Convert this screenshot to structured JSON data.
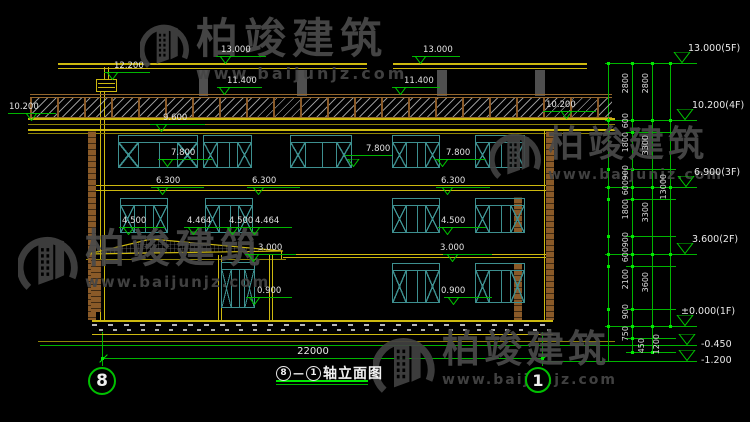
{
  "title": {
    "axis_start": "8",
    "dash": "—",
    "axis_end": "1",
    "text": "轴立面图"
  },
  "axes": {
    "left": "8",
    "right": "1"
  },
  "dims": {
    "overall_width": "22000"
  },
  "watermark": {
    "brand": "柏竣建筑",
    "url": "www.baijunjz.com",
    "brand_color": "#4a4a4a",
    "logo_color": "#424242",
    "instances": [
      {
        "x": 140,
        "y": 18,
        "lh": 56,
        "ts": 42,
        "ws": 16,
        "tls": 6,
        "wls": 3
      },
      {
        "x": 490,
        "y": 127,
        "lh": 58,
        "ts": 36,
        "ws": 14,
        "tls": 4,
        "wls": 2
      },
      {
        "x": 18,
        "y": 229,
        "lh": 68,
        "ts": 40,
        "ws": 15,
        "tls": 5,
        "wls": 2
      },
      {
        "x": 373,
        "y": 330,
        "lh": 70,
        "ts": 38,
        "ws": 14,
        "tls": 4,
        "wls": 2
      }
    ]
  },
  "colors": {
    "yellow": "#cdb90f",
    "yellow_dim": "#8f8408",
    "green": "#00b400",
    "green_bright": "#00e800",
    "brown": "#8a5a28",
    "brown_rail": "#96682e",
    "teal": "#3d8f8f",
    "post_gray": "#4f4f4f",
    "text": "#e2e2e2",
    "watermark": "#4a4a4a"
  },
  "geometry": {
    "rects": [
      [
        58,
        63,
        309,
        2,
        "y"
      ],
      [
        58,
        68,
        309,
        1,
        "y"
      ],
      [
        393,
        63,
        194,
        2,
        "y"
      ],
      [
        393,
        68,
        194,
        1,
        "y"
      ],
      [
        199,
        70,
        9,
        26,
        "d"
      ],
      [
        297,
        70,
        10,
        26,
        "d"
      ],
      [
        437,
        70,
        10,
        26,
        "d"
      ],
      [
        535,
        70,
        10,
        26,
        "d"
      ],
      [
        104,
        67,
        1,
        12,
        "y"
      ],
      [
        108,
        67,
        1,
        12,
        "y"
      ],
      [
        96,
        79,
        21,
        1,
        "y"
      ],
      [
        96,
        91,
        21,
        1,
        "y"
      ],
      [
        96,
        79,
        1,
        12,
        "y"
      ],
      [
        116,
        79,
        1,
        12,
        "y"
      ],
      [
        98,
        83,
        17,
        1,
        "y"
      ],
      [
        98,
        87,
        17,
        1,
        "y"
      ],
      [
        100,
        92,
        1,
        228,
        "y"
      ],
      [
        104,
        92,
        1,
        228,
        "y"
      ],
      [
        30,
        94,
        582,
        1,
        "b2"
      ],
      [
        30,
        97,
        582,
        1,
        "b2"
      ],
      [
        28,
        118,
        587,
        2,
        "y"
      ],
      [
        28,
        129,
        587,
        2,
        "y"
      ],
      [
        28,
        124,
        587,
        1,
        "y2"
      ],
      [
        28,
        133,
        587,
        1,
        "y2"
      ],
      [
        95,
        131,
        1,
        190,
        "y"
      ],
      [
        544,
        131,
        1,
        189,
        "y"
      ],
      [
        553,
        131,
        1,
        189,
        "y"
      ],
      [
        95,
        185,
        458,
        1,
        "y"
      ],
      [
        95,
        190,
        458,
        1,
        "y"
      ],
      [
        283,
        254,
        270,
        1,
        "y"
      ],
      [
        283,
        257,
        270,
        1,
        "y"
      ],
      [
        281,
        251,
        1,
        8,
        "y"
      ],
      [
        86,
        259,
        200,
        1,
        "y2"
      ],
      [
        218,
        255,
        1,
        65,
        "y"
      ],
      [
        221,
        255,
        1,
        65,
        "y"
      ],
      [
        269,
        255,
        1,
        65,
        "y"
      ],
      [
        272,
        255,
        1,
        65,
        "y"
      ],
      [
        38,
        341,
        577,
        1,
        "y2"
      ],
      [
        40,
        345,
        657,
        1,
        "g"
      ],
      [
        543,
        361,
        154,
        1,
        "g"
      ],
      [
        103,
        358,
        440,
        1,
        "g"
      ],
      [
        102,
        332,
        1,
        34,
        "g"
      ],
      [
        542,
        332,
        1,
        34,
        "g"
      ],
      [
        605,
        63,
        92,
        1,
        "g"
      ],
      [
        605,
        120,
        92,
        1,
        "g"
      ],
      [
        605,
        187,
        92,
        1,
        "g"
      ],
      [
        605,
        254,
        92,
        1,
        "g"
      ],
      [
        605,
        326,
        92,
        1,
        "g"
      ],
      [
        626,
        132,
        50,
        1,
        "g"
      ],
      [
        626,
        169,
        50,
        1,
        "g"
      ],
      [
        626,
        199,
        50,
        1,
        "g"
      ],
      [
        626,
        236,
        50,
        1,
        "g"
      ],
      [
        626,
        266,
        50,
        1,
        "g"
      ],
      [
        626,
        309,
        50,
        1,
        "g"
      ],
      [
        626,
        338,
        50,
        1,
        "g"
      ],
      [
        626,
        352,
        50,
        1,
        "g"
      ],
      [
        632,
        63,
        1,
        289,
        "g"
      ],
      [
        652,
        63,
        1,
        289,
        "g"
      ],
      [
        670,
        63,
        1,
        263,
        "g"
      ],
      [
        608,
        63,
        1,
        298,
        "g"
      ],
      [
        276,
        380,
        92,
        2,
        "gb"
      ],
      [
        276,
        384,
        92,
        1,
        "g"
      ]
    ],
    "parapet": [
      30,
      98,
      582,
      19
    ],
    "plinth": [
      92,
      320,
      461,
      12
    ],
    "pilasters": [
      [
        88,
        131,
        8,
        189
      ],
      [
        546,
        131,
        8,
        189
      ],
      [
        514,
        197,
        8,
        36
      ],
      [
        514,
        263,
        8,
        57
      ],
      [
        91,
        260,
        10,
        52
      ]
    ],
    "hip_canopy": {
      "x": 86,
      "y": 232,
      "w": 200,
      "h": 24,
      "points": "2,22 65,7 197,19"
    },
    "slashes": [
      [
        103,
        358
      ],
      [
        543,
        358
      ]
    ]
  },
  "windows": [
    [
      118,
      135,
      80,
      33,
      20
    ],
    [
      203,
      135,
      49,
      33,
      14
    ],
    [
      290,
      135,
      62,
      33,
      15
    ],
    [
      392,
      135,
      48,
      33,
      14
    ],
    [
      475,
      135,
      50,
      33,
      14
    ],
    [
      120,
      198,
      48,
      35,
      14
    ],
    [
      205,
      198,
      48,
      35,
      14
    ],
    [
      392,
      198,
      48,
      35,
      14
    ],
    [
      475,
      198,
      50,
      35,
      14
    ],
    [
      392,
      263,
      48,
      40,
      14
    ],
    [
      475,
      263,
      50,
      40,
      14
    ],
    [
      221,
      262,
      34,
      46,
      10
    ]
  ],
  "markers_left": [
    {
      "l": "13.000",
      "t": [
        225,
        64
      ],
      "ln": [
        216,
        266,
        56
      ],
      "tx": [
        221,
        46
      ]
    },
    {
      "l": "12.200",
      "t": [
        112,
        80
      ],
      "ln": [
        104,
        150,
        72
      ],
      "tx": [
        114,
        62
      ]
    },
    {
      "l": "11.400",
      "t": [
        224,
        95
      ],
      "ln": [
        217,
        262,
        87
      ],
      "tx": [
        227,
        77
      ]
    },
    {
      "l": "13.000",
      "t": [
        420,
        64
      ],
      "ln": [
        412,
        460,
        56
      ],
      "tx": [
        423,
        46
      ]
    },
    {
      "l": "11.400",
      "t": [
        400,
        95
      ],
      "ln": [
        392,
        440,
        87
      ],
      "tx": [
        404,
        77
      ]
    },
    {
      "l": "10.200",
      "t": [
        31,
        121
      ],
      "ln": [
        8,
        56,
        113
      ],
      "tx": [
        9,
        103
      ]
    },
    {
      "l": "10.200",
      "t": [
        566,
        119
      ],
      "ln": [
        543,
        596,
        111
      ],
      "tx": [
        546,
        101
      ]
    },
    {
      "l": "9.600",
      "t": [
        161,
        132
      ],
      "ln": [
        150,
        205,
        124
      ],
      "tx": [
        163,
        114
      ]
    },
    {
      "l": "7.800",
      "t": [
        167,
        167
      ],
      "ln": [
        158,
        212,
        159
      ],
      "tx": [
        171,
        149
      ]
    },
    {
      "l": "7.800",
      "t": [
        353,
        167
      ],
      "ln": [
        345,
        392,
        155
      ],
      "tx": [
        366,
        145
      ]
    },
    {
      "l": "7.800",
      "t": [
        442,
        167
      ],
      "ln": [
        434,
        486,
        159
      ],
      "tx": [
        446,
        149
      ]
    },
    {
      "l": "6.300",
      "t": [
        162,
        195
      ],
      "ln": [
        151,
        204,
        187
      ],
      "tx": [
        156,
        177
      ]
    },
    {
      "l": "6.300",
      "t": [
        258,
        195
      ],
      "ln": [
        247,
        300,
        187
      ],
      "tx": [
        252,
        177
      ]
    },
    {
      "l": "6.300",
      "t": [
        447,
        195
      ],
      "ln": [
        436,
        490,
        187
      ],
      "tx": [
        441,
        177
      ]
    },
    {
      "l": "4.500",
      "t": [
        128,
        235
      ],
      "ln": [
        119,
        165,
        227
      ],
      "tx": [
        122,
        217
      ]
    },
    {
      "l": "4.464",
      "t": [
        193,
        235
      ],
      "ln": [
        184,
        230,
        227
      ],
      "tx": [
        187,
        217
      ]
    },
    {
      "l": "4.500",
      "t": [
        232,
        235
      ],
      "ln": [
        225,
        271,
        227
      ],
      "tx": [
        229,
        217
      ]
    },
    {
      "l": "4.464",
      "t": [
        254,
        235
      ],
      "ln": [
        246,
        292,
        227
      ],
      "tx": [
        255,
        217
      ]
    },
    {
      "l": "4.500",
      "t": [
        447,
        235
      ],
      "ln": [
        438,
        486,
        227
      ],
      "tx": [
        441,
        217
      ]
    },
    {
      "l": "3.000",
      "t": [
        253,
        262
      ],
      "ln": [
        245,
        296,
        254
      ],
      "tx": [
        258,
        244
      ]
    },
    {
      "l": "3.000",
      "t": [
        452,
        262
      ],
      "ln": [
        443,
        492,
        254
      ],
      "tx": [
        440,
        244
      ]
    },
    {
      "l": "0.900",
      "t": [
        254,
        305
      ],
      "ln": [
        246,
        292,
        297
      ],
      "tx": [
        257,
        287
      ]
    },
    {
      "l": "0.900",
      "t": [
        453,
        305
      ],
      "ln": [
        444,
        492,
        297
      ],
      "tx": [
        441,
        287
      ]
    }
  ],
  "levels_right": [
    {
      "l": "13.000(5F)",
      "t": [
        682,
        63
      ],
      "tx": [
        688,
        44
      ]
    },
    {
      "l": "10.200(4F)",
      "t": [
        685,
        120
      ],
      "tx": [
        692,
        101
      ]
    },
    {
      "l": "6.900(3F)",
      "t": [
        686,
        187
      ],
      "tx": [
        694,
        168
      ]
    },
    {
      "l": "3.600(2F)",
      "t": [
        685,
        254
      ],
      "tx": [
        692,
        235
      ]
    },
    {
      "l": "±0.000(1F)",
      "t": [
        685,
        326
      ],
      "tx": [
        681,
        307
      ]
    },
    {
      "l": "-0.450",
      "t": [
        687,
        345
      ],
      "tx": [
        701,
        340
      ]
    },
    {
      "l": "-1.200",
      "t": [
        687,
        361
      ],
      "tx": [
        701,
        356
      ]
    }
  ],
  "chains": [
    {
      "x": 632,
      "lx": 621,
      "ticks": [
        63,
        120,
        132,
        169,
        187,
        199,
        236,
        254,
        266,
        309,
        326,
        338,
        352
      ],
      "labels": [
        [
          "2800",
          91
        ],
        [
          "600",
          126
        ],
        [
          "1800",
          150
        ],
        [
          "900",
          178
        ],
        [
          "600",
          193
        ],
        [
          "1800",
          217
        ],
        [
          "900",
          245
        ],
        [
          "600",
          260
        ],
        [
          "2100",
          287
        ],
        [
          "900",
          317
        ],
        [
          "750",
          339
        ],
        [
          "450",
          351,
          637
        ]
      ]
    },
    {
      "x": 652,
      "lx": 641,
      "ticks": [
        63,
        120,
        187,
        254,
        326,
        352
      ],
      "labels": [
        [
          "2800",
          91
        ],
        [
          "3300",
          153
        ],
        [
          "3300",
          220
        ],
        [
          "3600",
          290
        ],
        [
          "1200",
          352,
          652
        ]
      ]
    },
    {
      "x": 670,
      "lx": 659,
      "ticks": [
        63,
        120,
        187,
        254,
        326
      ],
      "labels": [
        [
          "13000",
          196
        ]
      ]
    },
    {
      "x": 608,
      "lx": 0,
      "ticks": [
        63,
        120,
        132,
        169,
        187,
        199,
        236,
        254,
        266,
        309,
        326
      ],
      "labels": []
    }
  ],
  "bubbles": [
    {
      "n": "8",
      "x": 88,
      "y": 367,
      "d": 28
    },
    {
      "n": "1",
      "x": 525,
      "y": 367,
      "d": 26
    }
  ]
}
